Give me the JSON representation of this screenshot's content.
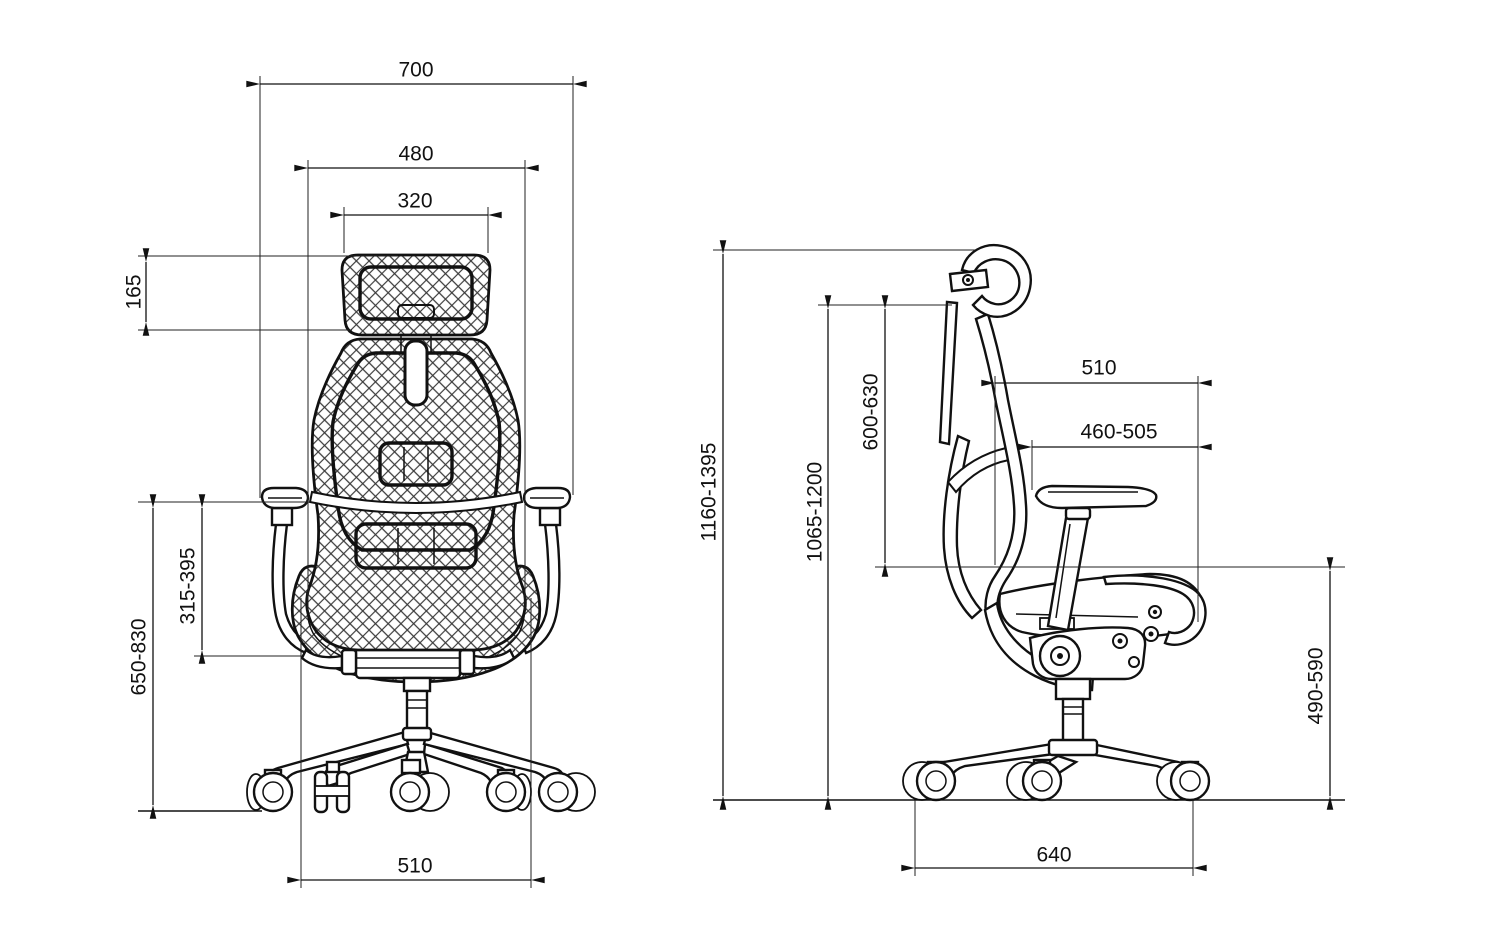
{
  "back": {
    "overall_width": "700",
    "backrest_width": "480",
    "headrest_width": "320",
    "headrest_height": "165",
    "armrest_height_from_seat": "315-395",
    "armrest_height_from_floor": "650-830",
    "base_width": "510"
  },
  "side": {
    "overall_height": "1160-1395",
    "backrest_top_height": "1065-1200",
    "backrest_length": "600-630",
    "back_to_seat_front_depth": "510",
    "seat_depth": "460-505",
    "seat_height": "490-590",
    "base_depth": "640"
  }
}
